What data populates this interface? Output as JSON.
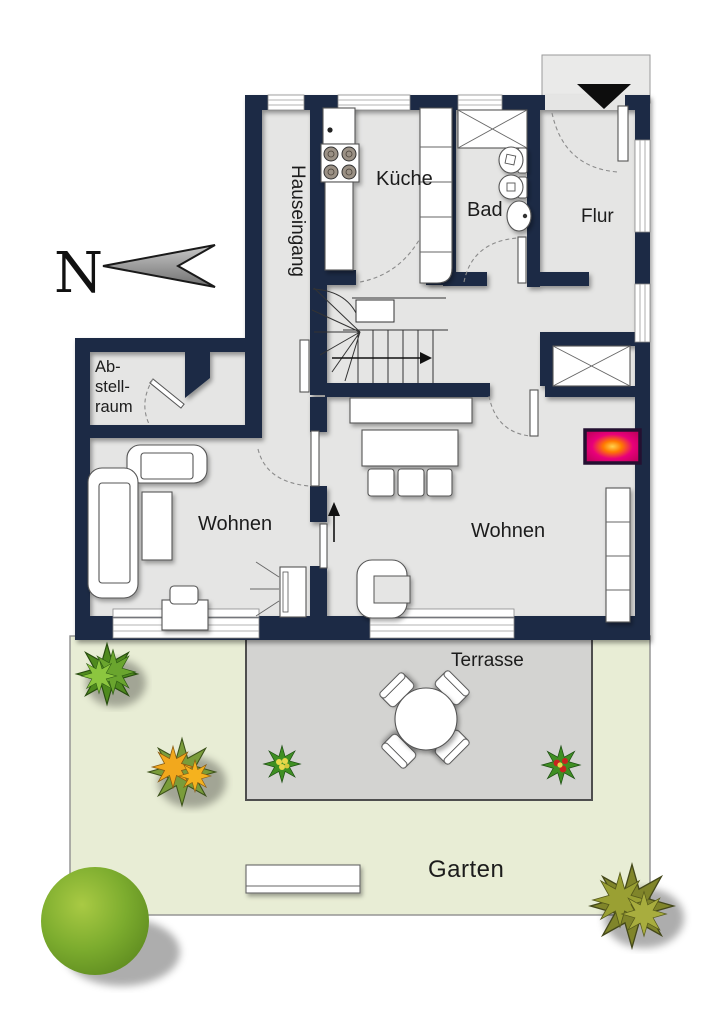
{
  "plan_title": "floor-plan-with-garden",
  "compass": {
    "letter": "N"
  },
  "rooms": {
    "hauseingang": {
      "label": "Hauseingang"
    },
    "kueche": {
      "label": "Küche"
    },
    "bad": {
      "label": "Bad"
    },
    "flur": {
      "label": "Flur"
    },
    "abstellraum": {
      "label_lines": [
        "Ab-",
        "stell-",
        "raum"
      ]
    },
    "wohnen_left": {
      "label": "Wohnen"
    },
    "wohnen_right": {
      "label": "Wohnen"
    }
  },
  "outdoor": {
    "terrasse": {
      "label": "Terrasse"
    },
    "garten": {
      "label": "Garten"
    }
  },
  "colors": {
    "wall": "#1b2a44",
    "floor": "#e5e5e4",
    "terrace": "#d3d3d1",
    "garden": "#e8edd5",
    "fireplace": "#dc0070",
    "fireplace_glow": "#ff9d00",
    "tree_green": "#7cac2e",
    "bush_green": "#6aa52e",
    "bush_orange": "#f2a81d",
    "bush_olive": "#9aa033",
    "flower_red": "#c8231f",
    "flower_yellow": "#e8d84a"
  }
}
